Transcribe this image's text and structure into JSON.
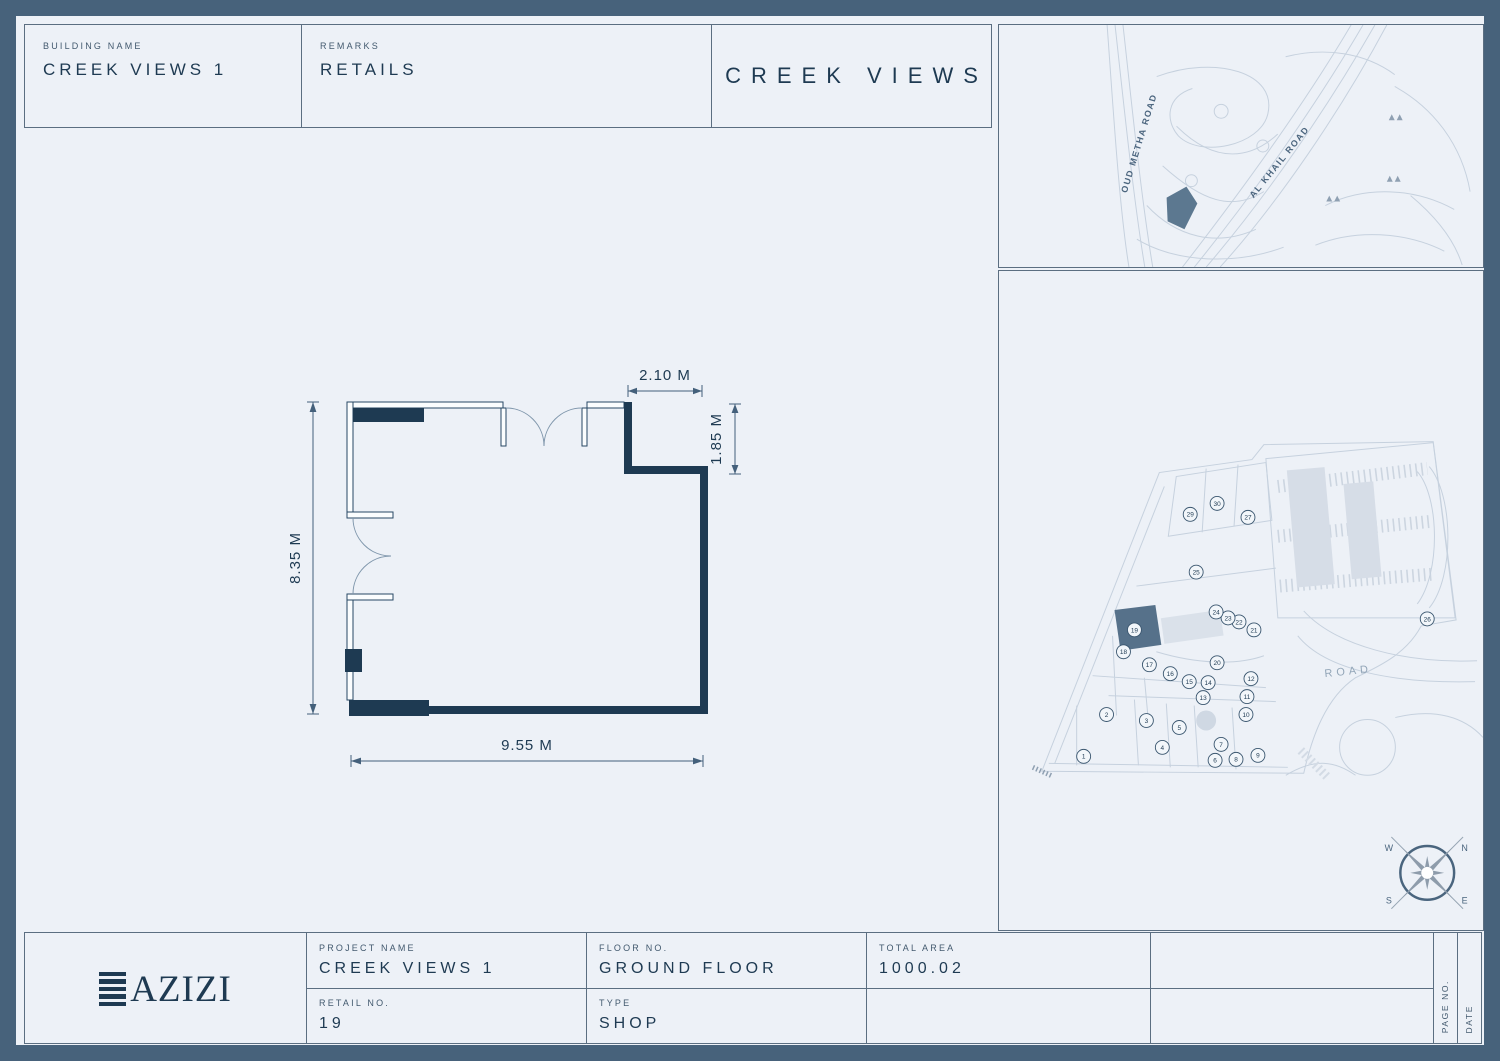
{
  "header": {
    "building_name_label": "BUILDING NAME",
    "building_name_value": "CREEK VIEWS 1",
    "remarks_label": "REMARKS",
    "remarks_value": "RETAILS",
    "title": "CREEK VIEWS"
  },
  "floor_plan": {
    "dim_top": "2.10 M",
    "dim_right": "1.85 M",
    "dim_left": "8.35 M",
    "dim_bottom": "9.55 M"
  },
  "location_map": {
    "road1": "OUD METHA ROAD",
    "road2": "AL KHAIL ROAD"
  },
  "site_plan": {
    "road_label": "ROAD",
    "highlighted_unit": "19",
    "units": [
      {
        "n": "1",
        "x": 1067,
        "y": 741
      },
      {
        "n": "2",
        "x": 1090,
        "y": 699
      },
      {
        "n": "3",
        "x": 1130,
        "y": 705
      },
      {
        "n": "4",
        "x": 1146,
        "y": 732
      },
      {
        "n": "5",
        "x": 1163,
        "y": 712
      },
      {
        "n": "6",
        "x": 1199,
        "y": 745
      },
      {
        "n": "7",
        "x": 1205,
        "y": 729
      },
      {
        "n": "8",
        "x": 1220,
        "y": 744
      },
      {
        "n": "9",
        "x": 1242,
        "y": 740
      },
      {
        "n": "10",
        "x": 1230,
        "y": 699
      },
      {
        "n": "11",
        "x": 1231,
        "y": 681
      },
      {
        "n": "12",
        "x": 1235,
        "y": 663
      },
      {
        "n": "13",
        "x": 1187,
        "y": 682
      },
      {
        "n": "14",
        "x": 1192,
        "y": 667
      },
      {
        "n": "15",
        "x": 1173,
        "y": 666
      },
      {
        "n": "16",
        "x": 1154,
        "y": 658
      },
      {
        "n": "17",
        "x": 1133,
        "y": 649
      },
      {
        "n": "18",
        "x": 1107,
        "y": 636
      },
      {
        "n": "19",
        "x": 1118,
        "y": 614
      },
      {
        "n": "20",
        "x": 1201,
        "y": 647
      },
      {
        "n": "21",
        "x": 1238,
        "y": 614
      },
      {
        "n": "22",
        "x": 1223,
        "y": 606
      },
      {
        "n": "23",
        "x": 1212,
        "y": 602
      },
      {
        "n": "24",
        "x": 1200,
        "y": 596
      },
      {
        "n": "25",
        "x": 1180,
        "y": 556
      },
      {
        "n": "26",
        "x": 1412,
        "y": 603
      },
      {
        "n": "27",
        "x": 1232,
        "y": 501
      },
      {
        "n": "29",
        "x": 1174,
        "y": 498
      },
      {
        "n": "30",
        "x": 1201,
        "y": 487
      }
    ],
    "compass": {
      "n": "N",
      "s": "S",
      "e": "E",
      "w": "W"
    }
  },
  "title_block": {
    "logo_text": "AZIZI",
    "project_name_label": "PROJECT NAME",
    "project_name_value": "CREEK VIEWS 1",
    "floor_no_label": "FLOOR NO.",
    "floor_no_value": "GROUND FLOOR",
    "total_area_label": "TOTAL AREA",
    "total_area_value": "1000.02",
    "retail_no_label": "RETAIL NO.",
    "retail_no_value": "19",
    "type_label": "TYPE",
    "type_value": "SHOP",
    "page_no_label": "PAGE NO.",
    "date_label": "DATE"
  }
}
